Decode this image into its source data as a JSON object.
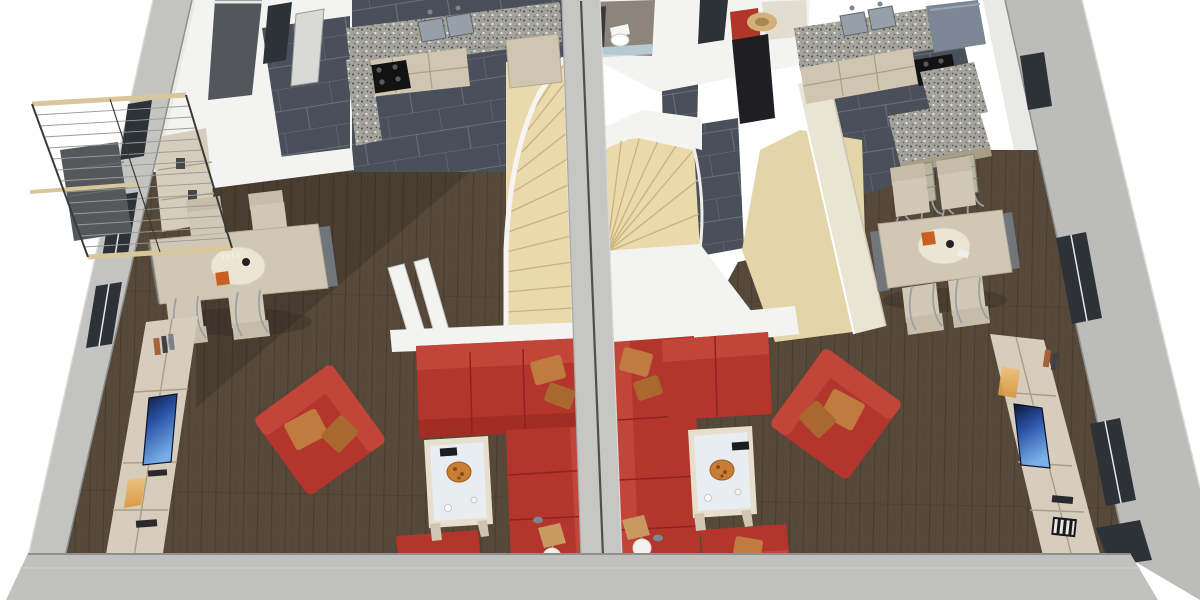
{
  "scene": {
    "title": "3D dollhouse floor plan — two mirrored duplex apartments",
    "view": "top-down cutaway render, walls cut at ceiling height",
    "units": [
      {
        "name": "left unit",
        "rooms": [
          "entry hall",
          "kitchen",
          "dining area",
          "living room",
          "winder staircase",
          "balcony"
        ],
        "furniture": {
          "kitchen": [
            "granite countertop",
            "double steel sink",
            "black cooktop",
            "beige cabinets",
            "tall cabinet"
          ],
          "dining": [
            "rectangular beige table",
            "round cream serving mat",
            "orange gift box",
            "black vase",
            "4 cantilever chairs",
            "sideboard"
          ],
          "living": [
            "red corner sofa with tan pillows",
            "red armchair with tan pillows",
            "red lounge chair",
            "glass coffee table",
            "orange plate",
            "white sphere floor lamp",
            "tan shade lamp",
            "tv wall unit",
            "flat-screen tv"
          ],
          "stairs": [
            "light wood winder stairs",
            "white stringer railing",
            "white partition posts"
          ],
          "balcony": [
            "beige rail bars",
            "steel cable infill",
            "gray deck"
          ]
        }
      },
      {
        "name": "right unit",
        "rooms": [
          "entry hall",
          "bathroom",
          "kitchen",
          "dining area",
          "living room",
          "winder staircase"
        ],
        "furniture": {
          "bathroom": [
            "toilet",
            "dark vanity",
            "glass screen"
          ],
          "entry": [
            "coat rack",
            "red jacket",
            "dark coat",
            "straw hat",
            "wall shelf"
          ],
          "kitchen": [
            "granite countertop",
            "double steel sink",
            "black cooktop",
            "granite island",
            "2 bar chairs",
            "blue-gray bench"
          ],
          "dining": [
            "rectangular beige table",
            "round cream serving mat",
            "orange gift box",
            "4 cantilever chairs"
          ],
          "living": [
            "red corner sofa with tan pillows",
            "red armchair with tan pillows",
            "red lounge chair with tan pillow",
            "glass coffee table",
            "orange plate",
            "white sphere floor lamp",
            "tan shade lamp",
            "tv wall unit",
            "flat-screen tv"
          ],
          "stairs": [
            "light wood winder stairs",
            "white curved stringer",
            "beige half wall",
            "light wood landing"
          ]
        }
      }
    ]
  },
  "palette": {
    "background": "#ffffff",
    "wall_gray": "#c3c3c2",
    "wall_gray_right": "#bcbcbb",
    "wall_bottom": "#c0c0bf",
    "wall_edge_dark": "#8f8f8d",
    "wall_edge_light": "#dadad8",
    "wall_gap": "#4e4e4e",
    "wall_white": "#f3f3f1",
    "inner_face": "#e9e9e7",
    "tile_dark": "#4a505a",
    "tile_grout": "#6b717c",
    "wood_floor": "#57493a",
    "wood_line": "#483c2f",
    "stair_wood": "#e9d9ab",
    "stair_line": "#c9b27e",
    "stair_white": "#f5f4f0",
    "landing_wood": "#e4d5a9",
    "granite": "#a3a39c",
    "granite_dark": "#4e4e49",
    "granite_light": "#e6e6df",
    "cabinet_beige": "#cfc5b0",
    "cabinet_shade": "#a99e87",
    "unit_beige": "#d6cdbc",
    "sofa_red": "#b3352c",
    "sofa_red_light": "#c2453a",
    "sofa_red_dark": "#8c241d",
    "pillow_tan": "#c07c40",
    "pillow_tan_dark": "#a8682f",
    "table_beige": "#d0c7b5",
    "mat_cream": "#ece5d3",
    "accent_orange": "#c8611f",
    "plate_orange": "#c87f35",
    "glass_blue": "#e7edf2",
    "metal": "#9aa0a6",
    "steel": "#97a0a8",
    "cooktop_black": "#121212",
    "window_dark": "#2d3138",
    "slab_dark": "#53565c",
    "door_gray": "#d9d9d7",
    "bench_blue": "#7b8794",
    "hat_straw": "#d2b079",
    "jacket_red": "#b23529",
    "coat_dark": "#1e1e23",
    "bath_wall": "#8d857b",
    "bath_glass": "#bcd6e2",
    "balcony_rail": "#d8c79b",
    "balcony_deck": "#55585b",
    "cable": "#9b9b99",
    "lamp_shade": "#c89a62",
    "lamp_white": "#f2f1ee",
    "tv_blue_dark": "#0d1835",
    "tv_blue": "#2b53a8",
    "tv_blue_hi": "#79b0e8",
    "candle_glow": "#d9953f",
    "shadow": "rgba(0,0,0,0.14)"
  }
}
